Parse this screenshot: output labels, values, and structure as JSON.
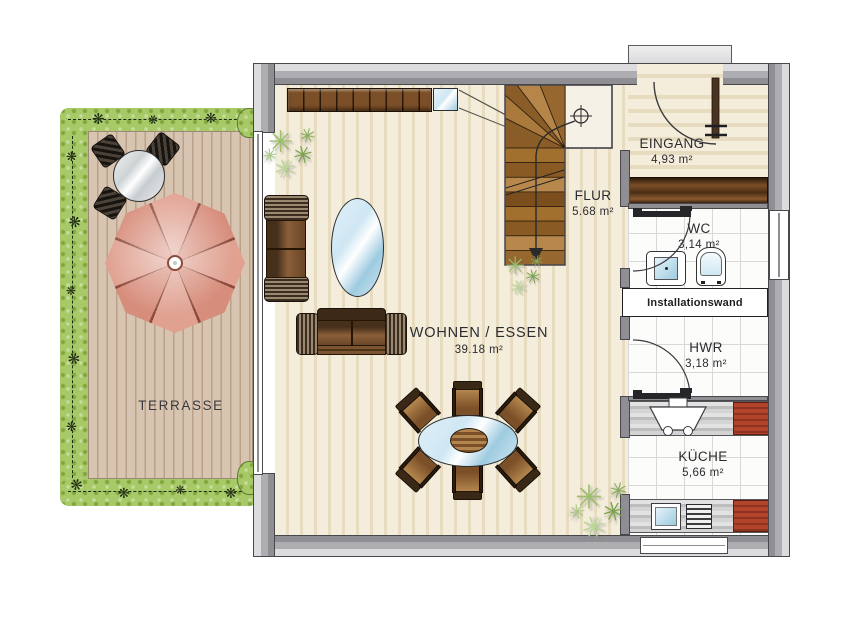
{
  "rooms": {
    "terrasse": {
      "label": "TERRASSE"
    },
    "wohnen_essen": {
      "label": "WOHNEN / ESSEN",
      "area": "39.18 m²"
    },
    "flur": {
      "label": "FLUR",
      "area": "5.68 m²"
    },
    "eingang": {
      "label": "EINGANG",
      "area": "4,93 m²"
    },
    "wc": {
      "label": "WC",
      "area": "3,14 m²"
    },
    "hwr": {
      "label": "HWR",
      "area": "3,18 m²"
    },
    "kueche": {
      "label": "KÜCHE",
      "area": "5,66 m²"
    }
  },
  "annotations": {
    "installationswand": "Installationswand"
  },
  "icons": {
    "plant_glyph": "✳",
    "hedge_glyph": "❋"
  },
  "colors": {
    "wall_light": "#dcdcdf",
    "wall_mid": "#aeaeb2",
    "wall_dark": "#8f8f93",
    "outline": "#47474c",
    "floor_cream": "#f4eddb",
    "floor_stripe": "#e7dcc0",
    "tile_white": "#fcfcfb",
    "tile_line": "#d8d8d5",
    "deck": "#d8c5b1",
    "deck_line": "#bba189",
    "hedge": "#a8c968",
    "hedge_dark": "#80a63d",
    "wood": "#7b4f27",
    "wood_light": "#b3854e",
    "glass": "#cfe7f3",
    "glass_deep": "#9ecbe0",
    "parasol": "#d78d7b",
    "parasol_alt": "#e0a191",
    "parasol_line": "#8c4a3a",
    "red": "#b2442c",
    "red_dark": "#8e3320"
  }
}
